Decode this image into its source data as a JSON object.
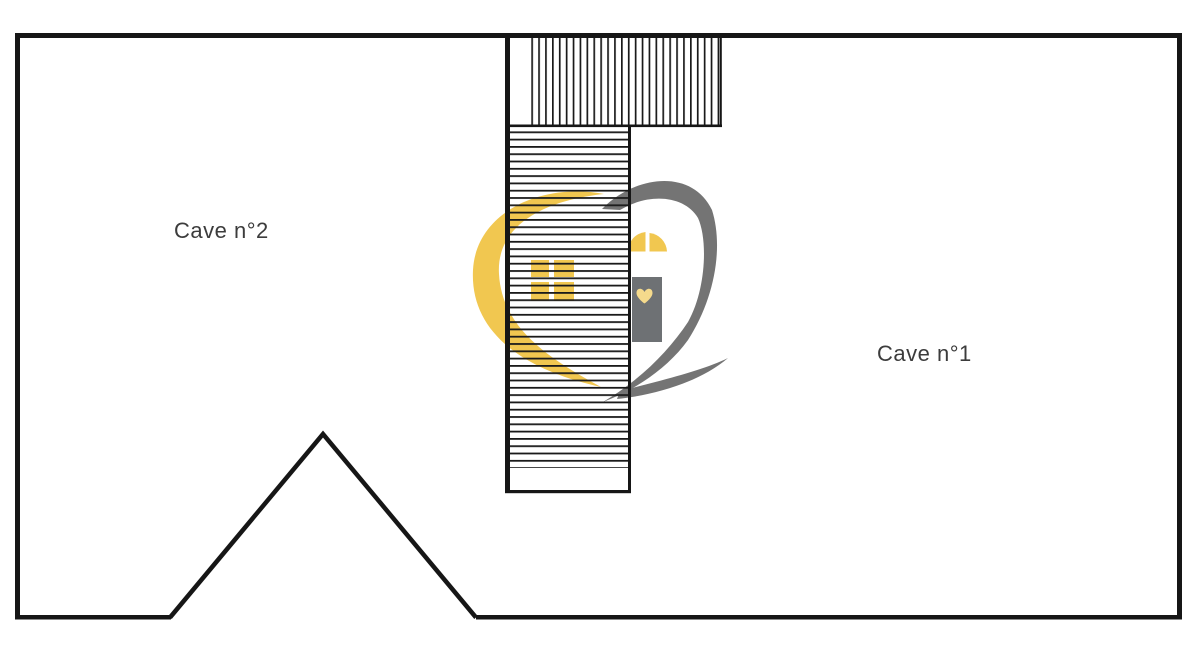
{
  "page": {
    "background": "#ffffff",
    "type_label": "floor plan"
  },
  "rooms": [
    {
      "label": "Cave n°2"
    },
    {
      "label": "Cave n°1"
    }
  ],
  "logo": {
    "name": "heart-house-watermark",
    "colors": {
      "yellow": "#F1C750",
      "yellow_light": "#F5DA8C",
      "gray": "#747474",
      "door_gray": "#6E7174"
    }
  },
  "plan": {
    "wall_color": "#161616",
    "hatch_color": "#1a1a1a"
  }
}
